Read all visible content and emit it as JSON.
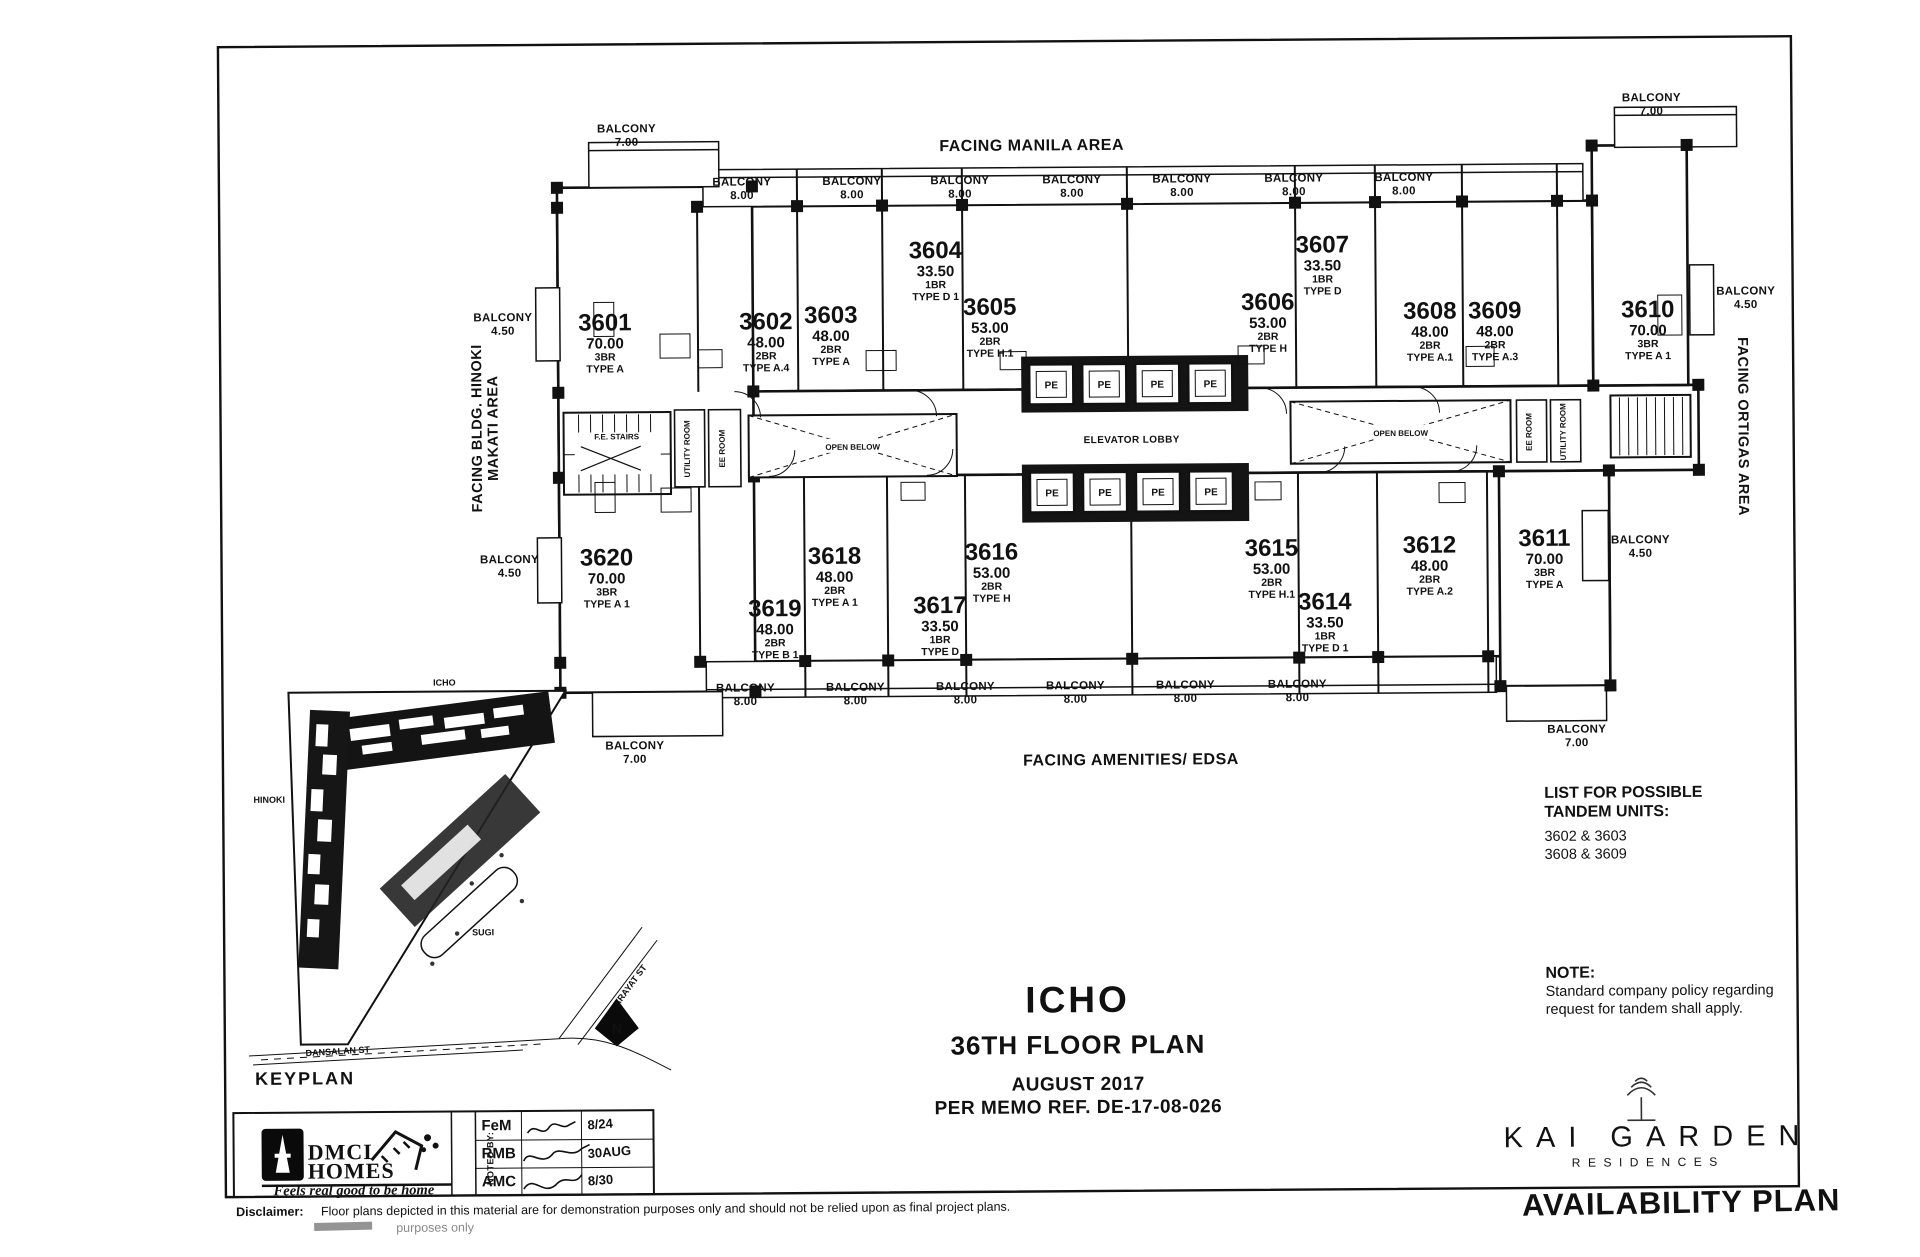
{
  "sheet": {
    "ink": "#111111",
    "facing": {
      "top": "FACING MANILA AREA",
      "left_line1": "FACING BLDG. HINOKI",
      "left_line2": "MAKATI AREA",
      "right": "FACING ORTIGAS AREA",
      "bottom": "FACING AMENITIES/ EDSA"
    },
    "title": {
      "project": "ICHO",
      "plan": "36TH FLOOR PLAN",
      "date": "AUGUST 2017",
      "memo": "PER MEMO REF. DE-17-08-026"
    },
    "tandem": {
      "heading_line1": "LIST FOR POSSIBLE",
      "heading_line2": "TANDEM UNITS:",
      "pairs": [
        "3602 & 3603",
        "3608 & 3609"
      ]
    },
    "note": {
      "heading": "NOTE:",
      "line1": "Standard company policy regarding",
      "line2": "request for tandem shall apply."
    },
    "keyplan": {
      "label": "KEYPLAN",
      "icho": "ICHO",
      "hinoki": "HINOKI",
      "sugi": "SUGI",
      "arayat": "ARAYAT ST",
      "dansalan": "DANSALAN ST",
      "north": "N"
    },
    "brand": {
      "dmci_line1": "DMCI",
      "dmci_line2": "HOMES",
      "tagline": "Feels real good to be home",
      "noted_by": "NOTED BY:",
      "approvals": [
        {
          "initials": "FeM",
          "date": "8/24"
        },
        {
          "initials": "RMB",
          "date": "30AUG"
        },
        {
          "initials": "AMC",
          "date": "8/30"
        }
      ]
    },
    "disclaimer": {
      "label": "Disclaimer:",
      "text": "Floor plans depicted in this material are for demonstration purposes only and should not be relied upon as final project plans.",
      "fragment": "purposes only"
    },
    "logo": {
      "line1": "KAI GARDEN",
      "line2": "RESIDENCES",
      "plan_type": "AVAILABILITY PLAN"
    },
    "plan": {
      "labels": {
        "elevator_lobby": "ELEVATOR LOBBY",
        "pe": "PE",
        "open_below": "OPEN BELOW",
        "fe_stairs": "F.E. STAIRS",
        "utility_room": "UTILITY ROOM",
        "ee_room": "EE ROOM",
        "balcony": "BALCONY"
      },
      "units": [
        {
          "num": "3601",
          "area": "70.00",
          "br": "3BR",
          "type": "TYPE A",
          "x": 607,
          "y": 328
        },
        {
          "num": "3602",
          "area": "48.00",
          "br": "2BR",
          "type": "TYPE A.4",
          "x": 768,
          "y": 328
        },
        {
          "num": "3603",
          "area": "48.00",
          "br": "2BR",
          "type": "TYPE A",
          "x": 833,
          "y": 322
        },
        {
          "num": "3604",
          "area": "33.50",
          "br": "1BR",
          "type": "TYPE D 1",
          "x": 938,
          "y": 258
        },
        {
          "num": "3605",
          "area": "53.00",
          "br": "2BR",
          "type": "TYPE H.1",
          "x": 992,
          "y": 315
        },
        {
          "num": "3606",
          "area": "53.00",
          "br": "2BR",
          "type": "TYPE H",
          "x": 1270,
          "y": 312
        },
        {
          "num": "3607",
          "area": "33.50",
          "br": "1BR",
          "type": "TYPE D",
          "x": 1325,
          "y": 255
        },
        {
          "num": "3608",
          "area": "48.00",
          "br": "2BR",
          "type": "TYPE A.1",
          "x": 1432,
          "y": 322
        },
        {
          "num": "3609",
          "area": "48.00",
          "br": "2BR",
          "type": "TYPE A.3",
          "x": 1497,
          "y": 322
        },
        {
          "num": "3610",
          "area": "70.00",
          "br": "3BR",
          "type": "TYPE A 1",
          "x": 1650,
          "y": 322
        },
        {
          "num": "3611",
          "area": "70.00",
          "br": "3BR",
          "type": "TYPE A",
          "x": 1545,
          "y": 550
        },
        {
          "num": "3612",
          "area": "48.00",
          "br": "2BR",
          "type": "TYPE A.2",
          "x": 1430,
          "y": 556
        },
        {
          "num": "3614",
          "area": "33.50",
          "br": "1BR",
          "type": "TYPE D 1",
          "x": 1325,
          "y": 612
        },
        {
          "num": "3615",
          "area": "53.00",
          "br": "2BR",
          "type": "TYPE H.1",
          "x": 1272,
          "y": 558
        },
        {
          "num": "3616",
          "area": "53.00",
          "br": "2BR",
          "type": "TYPE H",
          "x": 992,
          "y": 560
        },
        {
          "num": "3617",
          "area": "33.50",
          "br": "1BR",
          "type": "TYPE D",
          "x": 940,
          "y": 613
        },
        {
          "num": "3618",
          "area": "48.00",
          "br": "2BR",
          "type": "TYPE A 1",
          "x": 835,
          "y": 563
        },
        {
          "num": "3619",
          "area": "48.00",
          "br": "2BR",
          "type": "TYPE B 1",
          "x": 775,
          "y": 615
        },
        {
          "num": "3620",
          "area": "70.00",
          "br": "3BR",
          "type": "TYPE A 1",
          "x": 607,
          "y": 563
        }
      ],
      "balconies": [
        {
          "size": "7.00",
          "x": 630,
          "y": 130
        },
        {
          "size": "8.00",
          "x": 745,
          "y": 184
        },
        {
          "size": "8.00",
          "x": 855,
          "y": 184
        },
        {
          "size": "8.00",
          "x": 963,
          "y": 184
        },
        {
          "size": "8.00",
          "x": 1075,
          "y": 184
        },
        {
          "size": "8.00",
          "x": 1185,
          "y": 184
        },
        {
          "size": "8.00",
          "x": 1297,
          "y": 184
        },
        {
          "size": "8.00",
          "x": 1407,
          "y": 184
        },
        {
          "size": "7.00",
          "x": 1655,
          "y": 106
        },
        {
          "size": "4.50",
          "x": 505,
          "y": 318
        },
        {
          "size": "4.50",
          "x": 1748,
          "y": 300
        },
        {
          "size": "4.50",
          "x": 510,
          "y": 560
        },
        {
          "size": "4.50",
          "x": 1641,
          "y": 548
        },
        {
          "size": "8.00",
          "x": 745,
          "y": 690
        },
        {
          "size": "8.00",
          "x": 855,
          "y": 690
        },
        {
          "size": "8.00",
          "x": 965,
          "y": 690
        },
        {
          "size": "8.00",
          "x": 1075,
          "y": 690
        },
        {
          "size": "8.00",
          "x": 1185,
          "y": 690
        },
        {
          "size": "8.00",
          "x": 1297,
          "y": 690
        },
        {
          "size": "7.00",
          "x": 634,
          "y": 747
        },
        {
          "size": "7.00",
          "x": 1576,
          "y": 737
        }
      ],
      "elevators": [
        {
          "x": 1053,
          "y": 385
        },
        {
          "x": 1106,
          "y": 385
        },
        {
          "x": 1159,
          "y": 385
        },
        {
          "x": 1212,
          "y": 385
        },
        {
          "x": 1053,
          "y": 493
        },
        {
          "x": 1106,
          "y": 493
        },
        {
          "x": 1159,
          "y": 493
        },
        {
          "x": 1212,
          "y": 493
        }
      ]
    }
  }
}
